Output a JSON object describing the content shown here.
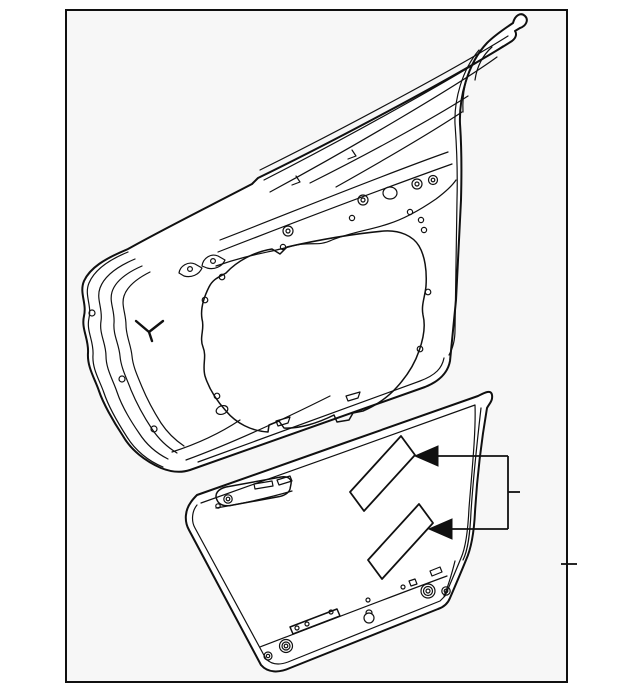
{
  "canvas": {
    "width": 640,
    "height": 692,
    "colors": {
      "page_bg": "#ffffff",
      "panel_bg": "#f7f7f7",
      "line": "#101010",
      "part_fill": "#ffffff",
      "arrow": "#101010"
    }
  },
  "diagram": {
    "kind": "vehicle door parts line drawing",
    "text_labels": [],
    "parts": [
      {
        "name": "door-shell",
        "desc": "door shell inner frame drawn tilted in upper area with window frame rails, access cutout, bolt holes and grommets"
      },
      {
        "name": "door-outer-panel",
        "desc": "outer door skin drawn tilted in lower area with hem flange, latch bracket and bottom fasteners"
      },
      {
        "name": "label-upper",
        "desc": "upper parallelogram label sticker on outer panel"
      },
      {
        "name": "label-lower",
        "desc": "lower parallelogram label sticker on outer panel"
      }
    ],
    "callout": {
      "arrows": 2,
      "style": "filled left-pointing arrowheads joined by a right-side bracket with a short center tick",
      "links": [
        "label-upper",
        "label-lower"
      ]
    },
    "frame": {
      "border": true,
      "right_edge_tick": true
    }
  }
}
